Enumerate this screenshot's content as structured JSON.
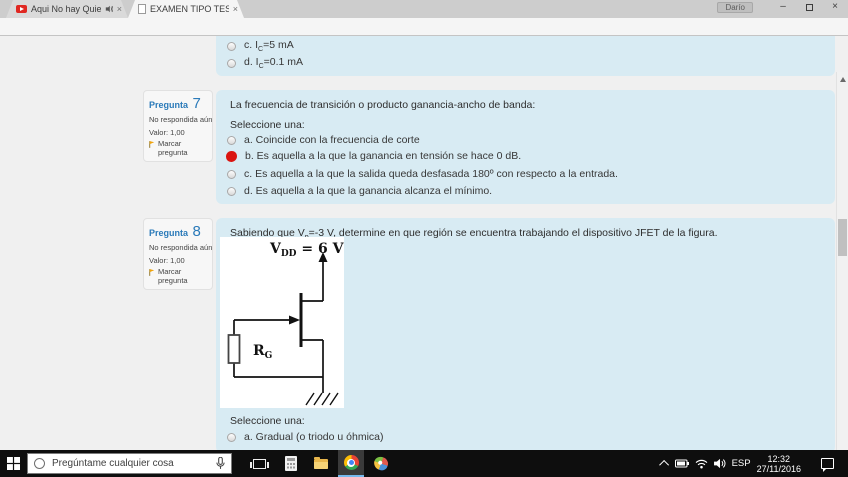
{
  "browser": {
    "tab1": {
      "title": "Aqui No hay Quien V",
      "close_glyph": "×"
    },
    "tab2": {
      "title": "EXAMEN TIPO TEST PRE",
      "close_glyph": "×"
    },
    "profile_name": "Darío",
    "controls": {
      "minimize": "–",
      "close": "×"
    },
    "nav": {
      "back": "←",
      "forward": "→",
      "reload": "↻",
      "home": "⌂",
      "star": "☆",
      "menu": "⋮"
    },
    "url": {
      "scheme": "https://",
      "host": "etsit.cv.uma.es",
      "path": "/mod/quiz/attempt.php?attempt=55692"
    }
  },
  "quiz": {
    "prev_question": {
      "options": [
        {
          "pre": "c. I",
          "sub": "C",
          "post": "=5 mA"
        },
        {
          "pre": "d. I",
          "sub": "C",
          "post": "=0.1 mA"
        }
      ]
    },
    "question7": {
      "label": "Pregunta",
      "number": "7",
      "status": "No respondida aún",
      "value": "Valor: 1,00",
      "flag_label": "Marcar pregunta",
      "text": "La frecuencia de transición o producto ganancia-ancho de banda:",
      "prompt": "Seleccione una:",
      "options": [
        {
          "text": "a. Coincide con la frecuencia de corte",
          "selected": false
        },
        {
          "text": "b. Es aquella a la que la ganancia en tensión se hace 0 dB.",
          "selected": true
        },
        {
          "text": "c. Es aquella a la que la salida queda desfasada 180º con respecto a la entrada.",
          "selected": false
        },
        {
          "text": "d. Es aquella a la que la ganancia alcanza el mínimo.",
          "selected": false
        }
      ]
    },
    "question8": {
      "label": "Pregunta",
      "number": "8",
      "status": "No respondida aún",
      "value": "Valor: 1,00",
      "flag_label": "Marcar pregunta",
      "text_pre": "Sabiendo que V",
      "text_sub": "p",
      "text_post": "=-3 V, determine en que región se encuentra trabajando el dispositivo JFET de la figura.",
      "prompt": "Seleccione una:",
      "options": [
        {
          "text": "a. Gradual (o triodo u óhmica)",
          "selected": false
        }
      ],
      "figure": {
        "vdd_main": "V",
        "vdd_sub": "DD",
        "vdd_eq": " = 6 V",
        "rg_main": "R",
        "rg_sub": "G"
      }
    }
  },
  "taskbar": {
    "search_placeholder": "Pregúntame cualquier cosa",
    "language": "ESP",
    "time": "12:32",
    "date": "27/11/2016"
  },
  "colors": {
    "accent_blue": "#2a7ab9",
    "question_bg": "#d8ebf3",
    "selected_red": "#da1410",
    "taskbar_bg": "#0e0e0e"
  }
}
